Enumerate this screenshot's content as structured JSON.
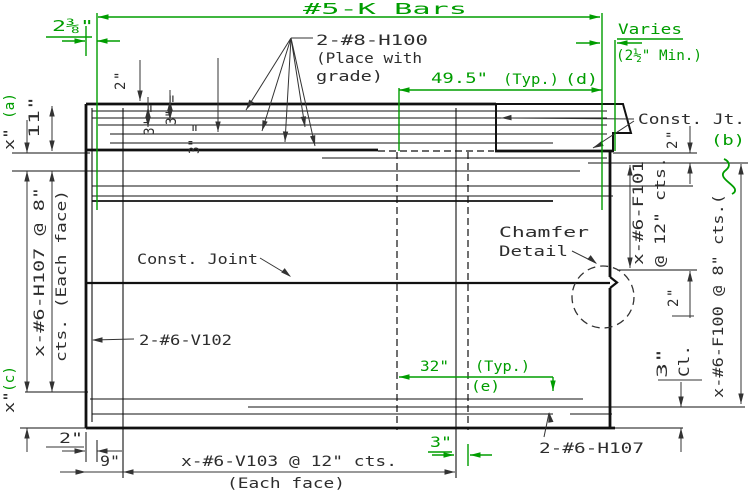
{
  "colors": {
    "green": "#009d00",
    "ink": "#2d2d2d",
    "line": "#111111"
  },
  "top": {
    "k_bars": "#5-K Bars",
    "corner_offset": "2⅜\"",
    "h100_line1": "2-#8-H100",
    "h100_line2": "(Place with",
    "h100_line3": "grade)",
    "varies": "Varies",
    "varies_min": "(2½\" Min.)",
    "dim_495": "49.5\"",
    "dim_495_typ": "(Typ.)",
    "dim_495_ref": "(d)",
    "dim_2": "2\"",
    "eq_1": "3\" =",
    "eq_2": "3\" =",
    "eq_3": "3\" ="
  },
  "left": {
    "ref_a": "(a)",
    "dim_x_top": "x\"",
    "dim_11": "11\"",
    "h107_line1": "x-#6-H107 @ 8\"",
    "h107_line2": "cts. (Each face)",
    "ref_c": "(c)",
    "dim_x_bottom": "x\"",
    "dim_2": "2\"",
    "dim_9": "9\""
  },
  "center": {
    "const_joint": "Const. Joint",
    "v102": "2-#6-V102",
    "dim_32": "32\"",
    "dim_32_typ": "(Typ.)",
    "dim_32_ref": "(e)",
    "chamfer_line1": "Chamfer",
    "chamfer_line2": "Detail"
  },
  "right": {
    "const_jt": "Const. Jt.",
    "ref_b": "(b)",
    "dim_2_top": "2\"",
    "f101_line1": "x-#6-F101",
    "f101_line2": "@ 12\" cts.",
    "dim_2_mid": "2\"",
    "dim_3": "3\"",
    "cl": "Cl.",
    "f100": "x-#6-F100 @ 8\" cts.("
  },
  "bottom": {
    "v103": "x-#6-V103 @ 12\" cts.",
    "each_face": "(Each face)",
    "dim_3": "3\"",
    "h107": "2-#6-H107"
  }
}
